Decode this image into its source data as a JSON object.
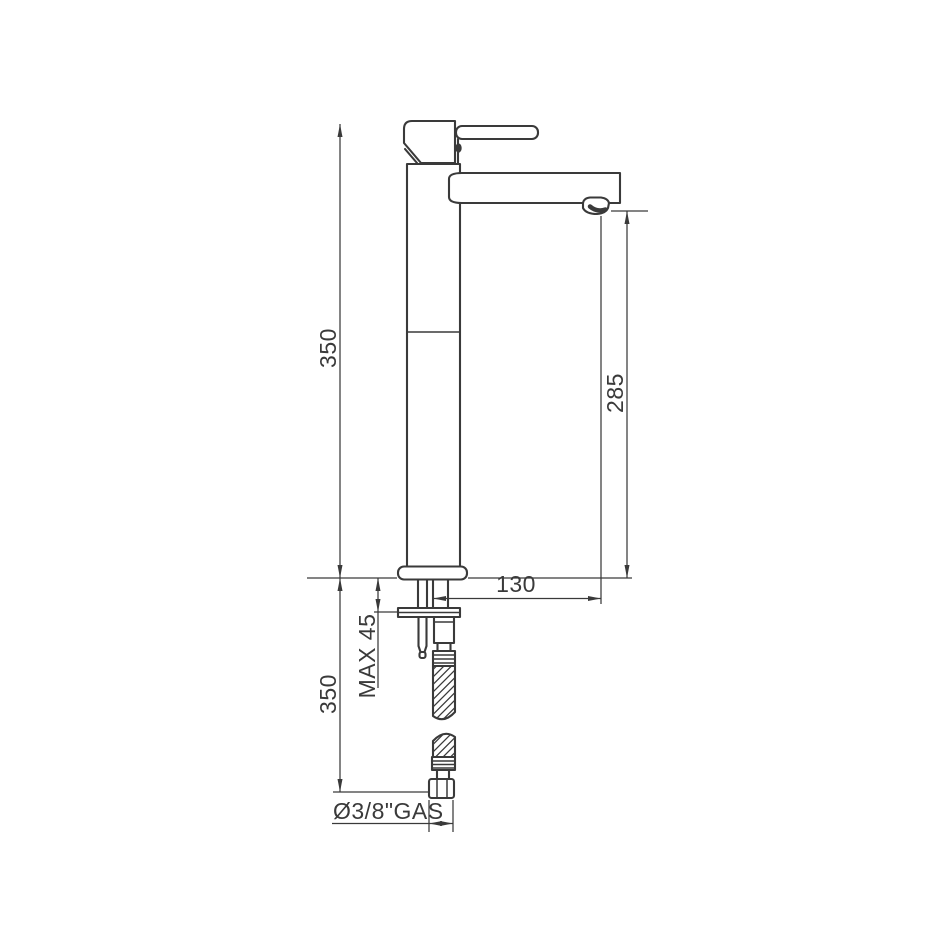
{
  "colors": {
    "line": "#3a3a3a",
    "background": "#ffffff"
  },
  "dimensions": {
    "total_height": "350",
    "outlet_height": "285",
    "spout_reach": "130",
    "max_mounting_thickness": "MAX 45",
    "hose_length": "350",
    "connection_thread": "Ø3/8\"GAS"
  }
}
